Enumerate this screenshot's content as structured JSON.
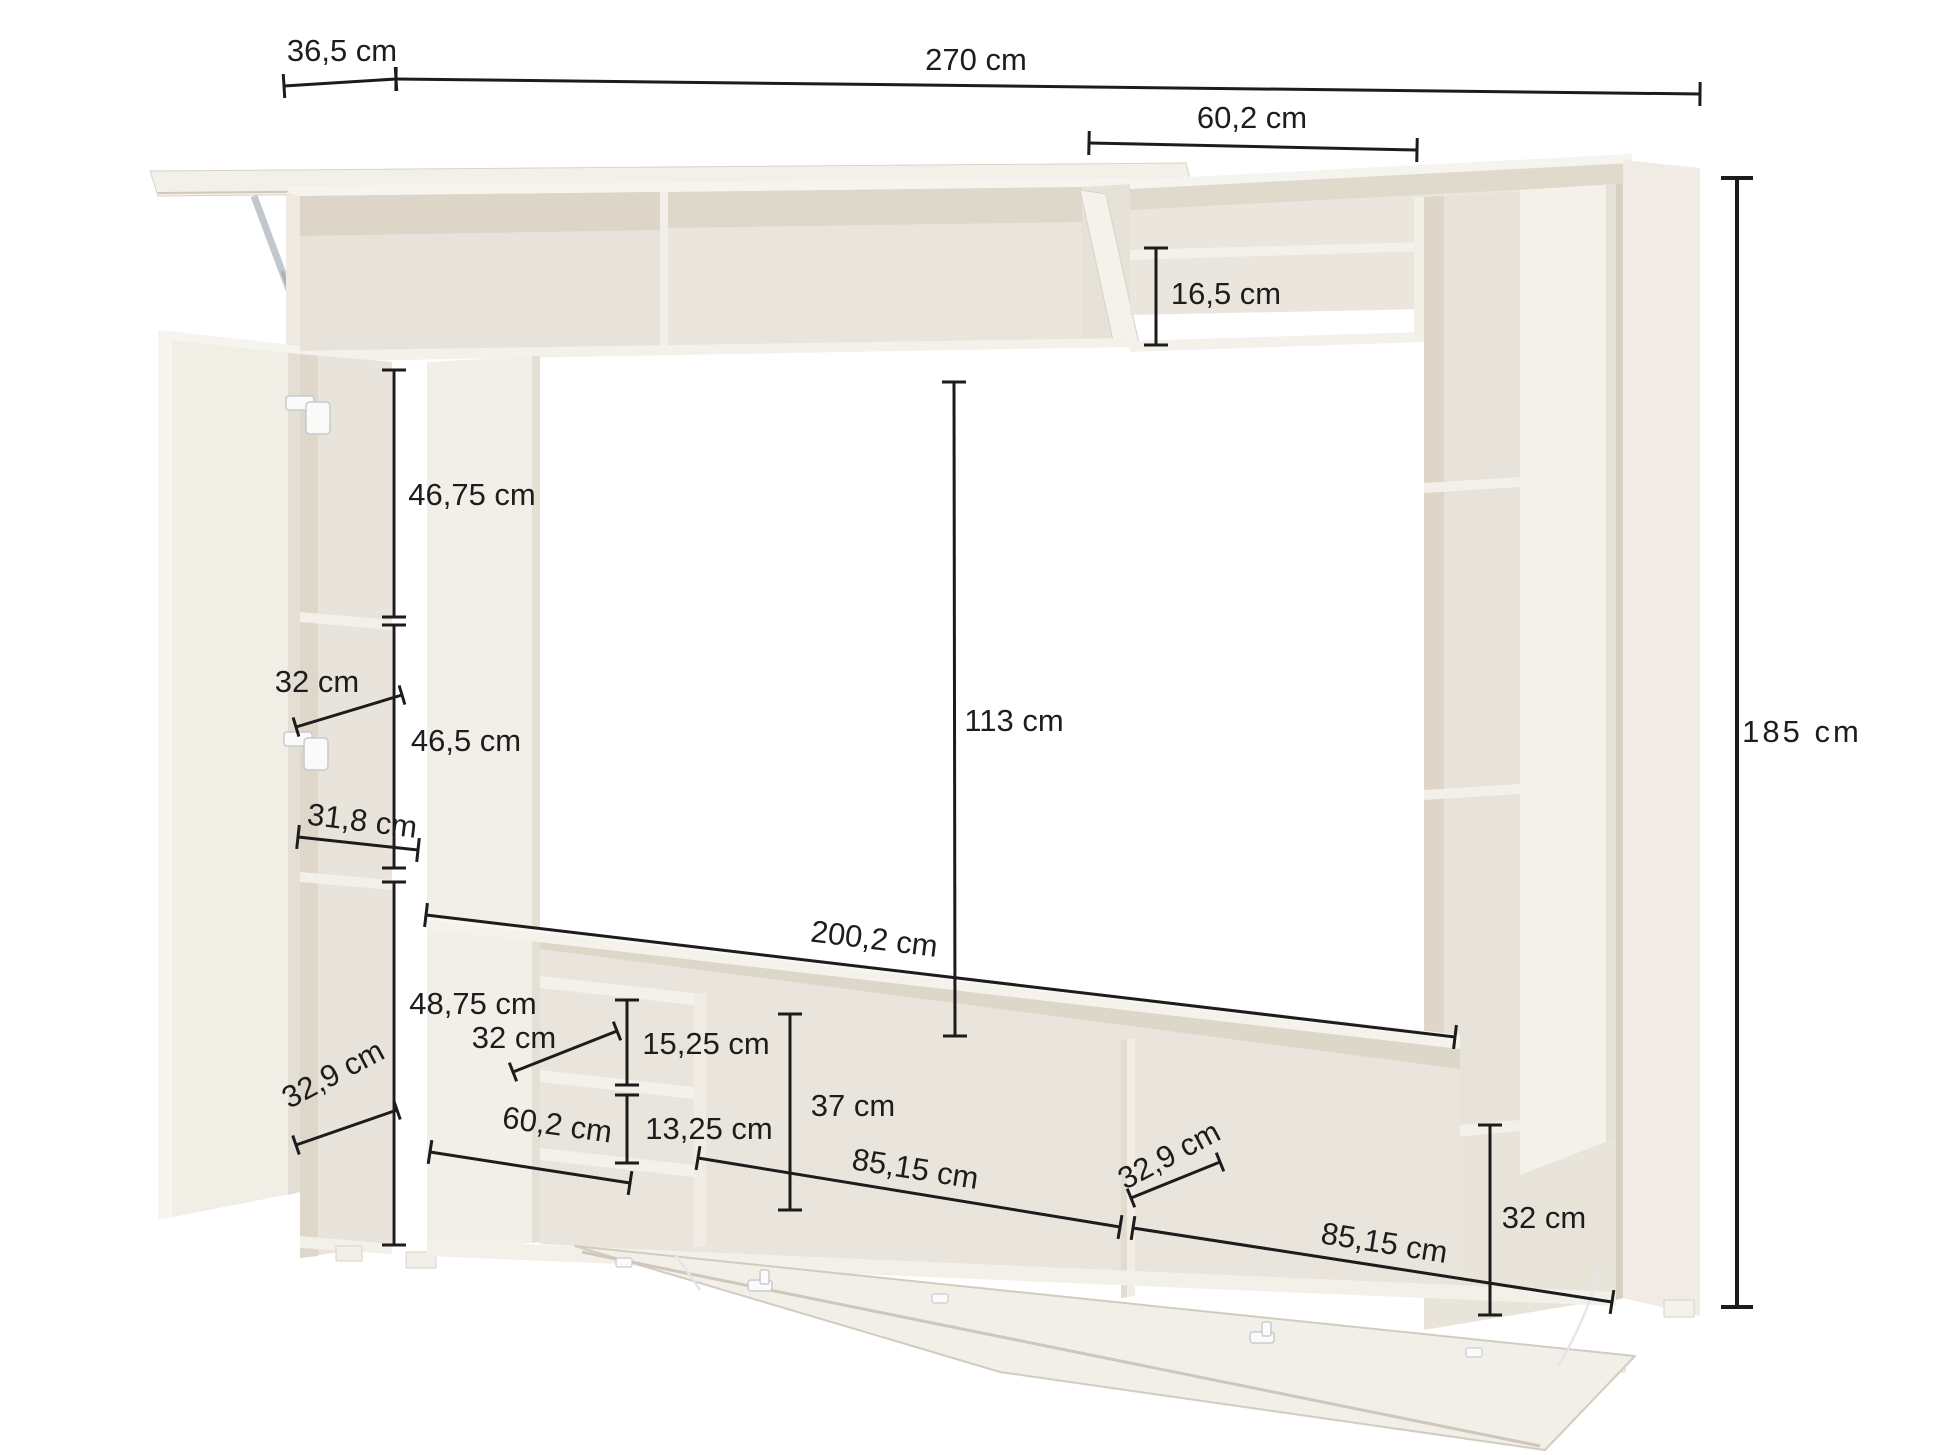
{
  "diagram": {
    "kind": "furniture-dimension-diagram",
    "unit": "cm",
    "colors": {
      "background": "#ffffff",
      "dimension_line": "#1c1c1c",
      "label_text": "#1d1d1d",
      "furniture_body": "#f2efe8",
      "furniture_interior": "#e8e3da",
      "furniture_shadow": "#ddd6c9",
      "hardware": "#c2c7cd"
    },
    "label_font_size": 31,
    "dimensions": [
      {
        "id": "width-left-36-5",
        "label": "36,5 cm",
        "label_x": 342,
        "label_y": 53,
        "rot": 0,
        "x1": 284,
        "y1": 86,
        "x2": 396,
        "y2": 79,
        "tick": 24,
        "lw": 3
      },
      {
        "id": "width-total-270",
        "label": "270 cm",
        "label_x": 976,
        "label_y": 62,
        "rot": 0,
        "x1": 396,
        "y1": 79,
        "x2": 1700,
        "y2": 94,
        "tick": 24,
        "lw": 3
      },
      {
        "id": "top-right-60-2",
        "label": "60,2 cm",
        "label_x": 1252,
        "label_y": 120,
        "rot": 0,
        "x1": 1089,
        "y1": 143,
        "x2": 1417,
        "y2": 150,
        "tick": 24,
        "lw": 3
      },
      {
        "id": "shelf-gap-16-5",
        "label": "16,5 cm",
        "label_x": 1226,
        "label_y": 296,
        "rot": 0,
        "x1": 1156,
        "y1": 248,
        "x2": 1156,
        "y2": 345,
        "tick": 24,
        "lw": 3
      },
      {
        "id": "left-46-75",
        "label": "46,75 cm",
        "label_x": 472,
        "label_y": 497,
        "rot": 0,
        "x1": 394,
        "y1": 370,
        "x2": 394,
        "y2": 617,
        "tick": 24,
        "lw": 3
      },
      {
        "id": "left-depth-32",
        "label": "32 cm",
        "label_x": 317,
        "label_y": 684,
        "rot": 0,
        "x1": 296,
        "y1": 727,
        "x2": 402,
        "y2": 695,
        "tick": 20,
        "lw": 3
      },
      {
        "id": "left-46-5",
        "label": "46,5 cm",
        "label_x": 466,
        "label_y": 743,
        "rot": 0,
        "x1": 394,
        "y1": 625,
        "x2": 394,
        "y2": 868,
        "tick": 24,
        "lw": 3
      },
      {
        "id": "left-31-8",
        "label": "31,8 cm",
        "label_x": 362,
        "label_y": 823,
        "rot": 7,
        "x1": 298,
        "y1": 837,
        "x2": 418,
        "y2": 850,
        "tick": 24,
        "lw": 3
      },
      {
        "id": "left-depth-32-9",
        "label": "32,9 cm",
        "label_x": 334,
        "label_y": 1076,
        "rot": -28,
        "x1": 296,
        "y1": 1145,
        "x2": 397,
        "y2": 1110,
        "tick": 20,
        "lw": 3
      },
      {
        "id": "left-48-75",
        "label": "48,75 cm",
        "label_x": 473,
        "label_y": 1006,
        "rot": 0,
        "x1": 394,
        "y1": 882,
        "x2": 394,
        "y2": 1245,
        "tick": 24,
        "lw": 3
      },
      {
        "id": "bench-depth-32",
        "label": "32 cm",
        "label_x": 514,
        "label_y": 1040,
        "rot": 0,
        "x1": 513,
        "y1": 1072,
        "x2": 617,
        "y2": 1031,
        "tick": 20,
        "lw": 3
      },
      {
        "id": "bench-15-25",
        "label": "15,25 cm",
        "label_x": 706,
        "label_y": 1046,
        "rot": 0,
        "x1": 627,
        "y1": 1000,
        "x2": 627,
        "y2": 1085,
        "tick": 24,
        "lw": 3
      },
      {
        "id": "bench-13-25",
        "label": "13,25 cm",
        "label_x": 709,
        "label_y": 1131,
        "rot": 0,
        "x1": 627,
        "y1": 1095,
        "x2": 627,
        "y2": 1163,
        "tick": 24,
        "lw": 3
      },
      {
        "id": "bench-60-2",
        "label": "60,2 cm",
        "label_x": 557,
        "label_y": 1127,
        "rot": 8,
        "x1": 430,
        "y1": 1152,
        "x2": 630,
        "y2": 1183,
        "tick": 24,
        "lw": 3
      },
      {
        "id": "bench-37",
        "label": "37 cm",
        "label_x": 853,
        "label_y": 1108,
        "rot": 0,
        "x1": 790,
        "y1": 1014,
        "x2": 790,
        "y2": 1210,
        "tick": 24,
        "lw": 3
      },
      {
        "id": "tv-height-113",
        "label": "113 cm",
        "label_x": 1014,
        "label_y": 723,
        "rot": 0,
        "x1": 954,
        "y1": 382,
        "x2": 955,
        "y2": 1036,
        "tick": 24,
        "lw": 3
      },
      {
        "id": "tv-width-200-2",
        "label": "200,2 cm",
        "label_x": 874,
        "label_y": 941,
        "rot": 7,
        "x1": 426,
        "y1": 915,
        "x2": 1455,
        "y2": 1037,
        "tick": 24,
        "lw": 3
      },
      {
        "id": "bench-85-15-a",
        "label": "85,15 cm",
        "label_x": 915,
        "label_y": 1171,
        "rot": 9,
        "x1": 698,
        "y1": 1158,
        "x2": 1120,
        "y2": 1227,
        "tick": 24,
        "lw": 3
      },
      {
        "id": "bench-depth-32-9",
        "label": "32,9 cm",
        "label_x": 1170,
        "label_y": 1157,
        "rot": -28,
        "x1": 1131,
        "y1": 1198,
        "x2": 1220,
        "y2": 1162,
        "tick": 20,
        "lw": 3
      },
      {
        "id": "bench-85-15-b",
        "label": "85,15 cm",
        "label_x": 1384,
        "label_y": 1245,
        "rot": 9,
        "x1": 1133,
        "y1": 1228,
        "x2": 1612,
        "y2": 1302,
        "tick": 24,
        "lw": 3
      },
      {
        "id": "right-32",
        "label": "32 cm",
        "label_x": 1544,
        "label_y": 1220,
        "rot": 0,
        "x1": 1490,
        "y1": 1125,
        "x2": 1490,
        "y2": 1315,
        "tick": 24,
        "lw": 3
      },
      {
        "id": "height-total-185",
        "label": "185 cm",
        "label_x": 1802,
        "label_y": 734,
        "rot": 0,
        "x1": 1737,
        "y1": 178,
        "x2": 1737,
        "y2": 1307,
        "tick": 32,
        "lw": 4,
        "ls": 3
      }
    ]
  }
}
